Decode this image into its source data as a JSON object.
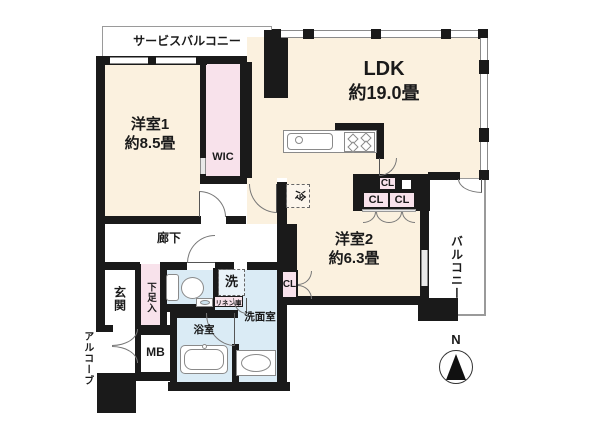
{
  "colors": {
    "room_floor": "#FBF1DF",
    "closet_floor": "#F8E2EB",
    "water_floor": "#DAEBF5",
    "wall": "#1A1A1A",
    "outdoor": "#FFFFFF"
  },
  "rooms": {
    "service_balcony": {
      "label": "サービスバルコニー"
    },
    "room1": {
      "name": "洋室1",
      "size": "約8.5畳"
    },
    "wic": {
      "label": "WIC"
    },
    "ldk": {
      "name": "LDK",
      "size": "約19.0畳"
    },
    "room2": {
      "name": "洋室2",
      "size": "約6.3畳"
    },
    "balcony": {
      "label": "バルコニー"
    },
    "hallway": {
      "label": "廊下"
    },
    "entrance": {
      "label": "玄関"
    },
    "shoe_cabinet": {
      "label": "下足入"
    },
    "alcove": {
      "label": "アルコーブ"
    },
    "meter_box": {
      "label": "MB"
    },
    "bathroom": {
      "label": "浴室"
    },
    "washroom": {
      "label": "洗面室"
    }
  },
  "fixtures": {
    "refrigerator": {
      "label": "冷"
    },
    "washer": {
      "label": "洗"
    },
    "linen": {
      "label": "リネン庫"
    },
    "closet_top": {
      "label": "CL"
    },
    "closet_row_left": {
      "label": "CL"
    },
    "closet_row_right": {
      "label": "CL"
    },
    "closet_room2": {
      "label": "CL"
    }
  },
  "compass": {
    "north": "N"
  }
}
